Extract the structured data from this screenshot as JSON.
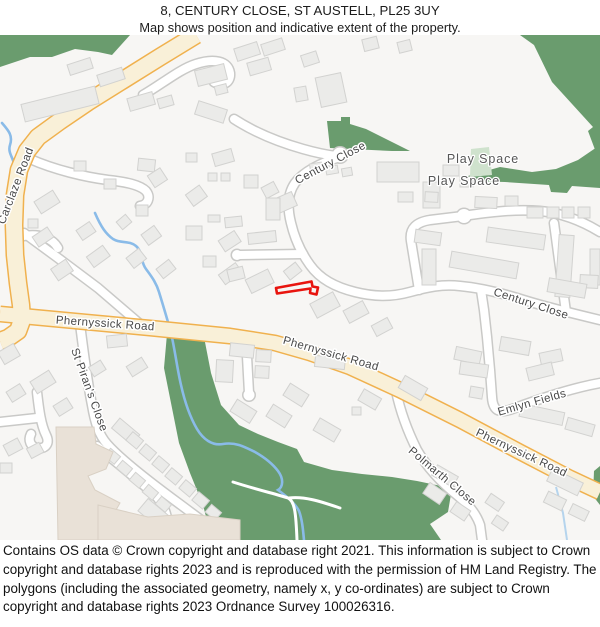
{
  "header": {
    "title": "8, CENTURY CLOSE, ST AUSTELL, PL25 3UY",
    "subtitle": "Map shows position and indicative extent of the property."
  },
  "map": {
    "labels": {
      "carclaze": "Carclaze Road",
      "century_top": "Century Close",
      "century_right": "Century Close",
      "play_space_1": "Play Space",
      "play_space_2": "Play Space",
      "phernyssick_1": "Phernyssick Road",
      "phernyssick_2": "Phernyssick Road",
      "phernyssick_3": "Phernyssick Road",
      "st_pirans": "St Piran's Close",
      "polmarth": "Polmarth Close",
      "emlyn": "Emlyn Fields"
    },
    "colors": {
      "background": "#f7f6f4",
      "green_area": "#6a9c6e",
      "light_green": "#cfe2cd",
      "building_fill": "#ebebe9",
      "building_stroke": "#d2d2d0",
      "special_building_fill": "#e9e1d7",
      "special_building_stroke": "#d9d0c4",
      "main_road_fill": "#f9f0d8",
      "main_road_casing": "#f0b14e",
      "minor_road_fill": "#ffffff",
      "minor_road_casing": "#c9c9c7",
      "water": "#8abbe8",
      "water_light": "#b5d4ed",
      "path_through_green": "#ffffff",
      "plot_outline": "#e8140e",
      "label_color": "#484848"
    }
  },
  "footer": {
    "text": "Contains OS data © Crown copyright and database right 2021. This information is subject to Crown copyright and database rights 2023 and is reproduced with the permission of HM Land Registry. The polygons (including the associated geometry, namely x, y co-ordinates) are subject to Crown copyright and database rights 2023 Ordnance Survey 100026316."
  }
}
